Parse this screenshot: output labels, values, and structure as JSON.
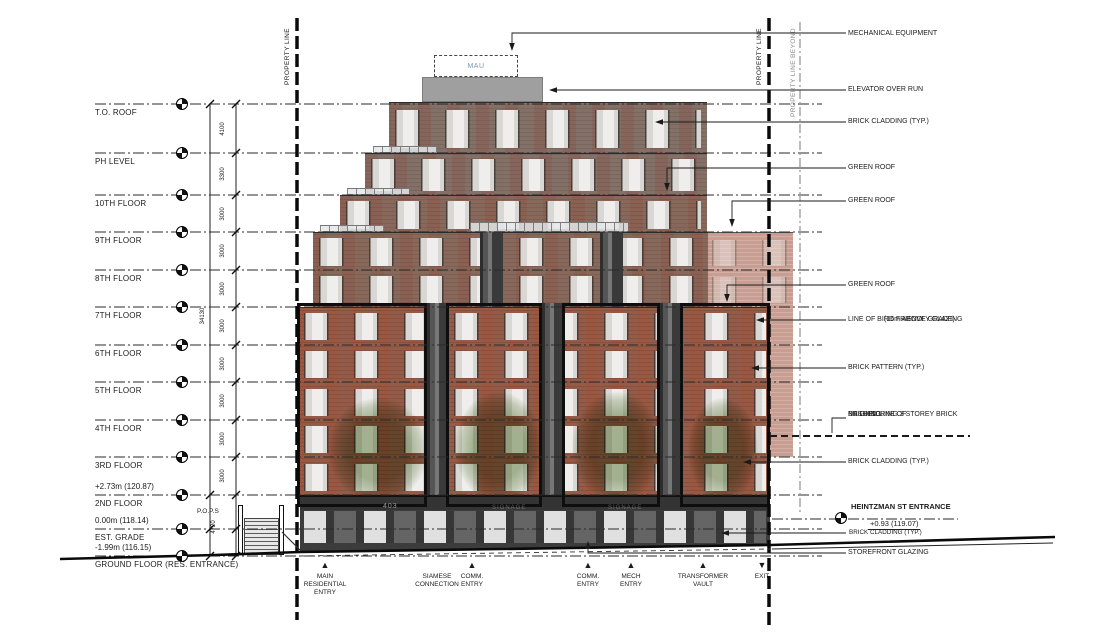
{
  "levels": [
    {
      "label": "T.O. ROOF"
    },
    {
      "label": "PH LEVEL"
    },
    {
      "label": "10TH FLOOR"
    },
    {
      "label": "9TH FLOOR"
    },
    {
      "label": "8TH FLOOR"
    },
    {
      "label": "7TH FLOOR"
    },
    {
      "label": "6TH FLOOR"
    },
    {
      "label": "5TH FLOOR"
    },
    {
      "label": "4TH FLOOR"
    },
    {
      "label": "3RD FLOOR"
    },
    {
      "label": "2ND FLOOR",
      "elevation": "+2.73m (120.87)"
    },
    {
      "label": "EST. GRADE",
      "elevation": "0.00m (118.14)"
    },
    {
      "label": "GROUND FLOOR (RES. ENTRANCE)",
      "elevation": "-1.99m (116.15)"
    }
  ],
  "dimensions": {
    "total": "34130",
    "bottom": "4720",
    "segments": [
      "4100",
      "3300",
      "3000",
      "3000",
      "3000",
      "3000",
      "3000",
      "3000",
      "3000",
      "3000"
    ]
  },
  "property_lines": {
    "left": "PROPERTY LINE",
    "right": "PROPERTY LINE",
    "beyond": "PROPERTY LINE BEYOND"
  },
  "annotations": [
    {
      "lines": [
        "MECHANICAL EQUIPMENT"
      ]
    },
    {
      "lines": [
        "ELEVATOR OVER RUN"
      ]
    },
    {
      "lines": [
        "BRICK CLADDING (TYP.)"
      ]
    },
    {
      "lines": [
        "GREEN ROOF"
      ]
    },
    {
      "lines": [
        "GREEN ROOF"
      ]
    },
    {
      "lines": [
        "GREEN ROOF"
      ]
    },
    {
      "lines": [
        "LINE OF BIRD FRIENDLY GLAZING",
        "(16m ABOVE GRADE)"
      ]
    },
    {
      "lines": [
        "BRICK PATTERN (TYP.)"
      ]
    },
    {
      "lines": [
        "DASHED LINE OF",
        "NEIGHBORING 3 STOREY BRICK",
        "BUILDING"
      ]
    },
    {
      "lines": [
        "BRICK CLADDING (TYP.)"
      ]
    },
    {
      "lines": [
        "STOREFRONT GLAZING"
      ]
    }
  ],
  "heintzman": {
    "title": "HEINTZMAN ST ENTRANCE",
    "elevation": "+0.93 (119.07)",
    "note": "BRICK CLADDING (TYP.)"
  },
  "entries": [
    {
      "lines": [
        "MAIN",
        "RESIDENTIAL",
        "ENTRY"
      ]
    },
    {
      "lines": [
        "SIAMESE",
        "CONNECTION"
      ]
    },
    {
      "lines": [
        "COMM.",
        "ENTRY"
      ]
    },
    {
      "lines": [
        "COMM.",
        "ENTRY"
      ]
    },
    {
      "lines": [
        "MECH",
        "ENTRY"
      ]
    },
    {
      "lines": [
        "TRANSFORMER",
        "VAULT"
      ]
    },
    {
      "lines": [
        "EXIT"
      ]
    }
  ],
  "building": {
    "mau": "MAU",
    "pops": "P.O.P.S",
    "address": "403",
    "signage": "SIGNAGE"
  },
  "colors": {
    "brick_main": "#9b5f4b",
    "brick_upper": "#8a766e",
    "brick_mid": "#8f6d60",
    "brick_beyond": "#c99e92",
    "storefront": "#3c3c3c",
    "elevator": "#9f9f9f",
    "tree": "#688446",
    "mau_text": "#7d9ab5"
  }
}
